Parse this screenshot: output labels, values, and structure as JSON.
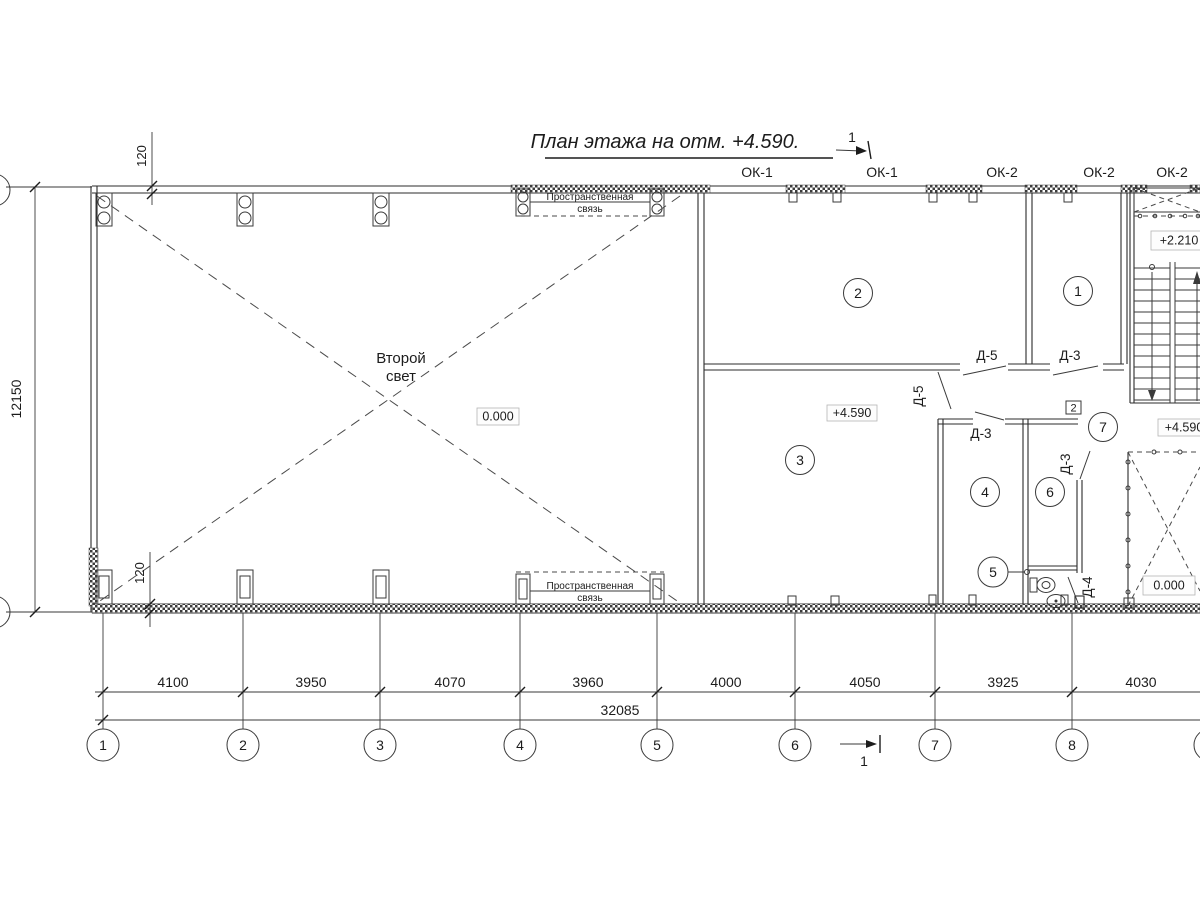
{
  "title": "План этажа на отм. +4.590.",
  "section_marker": {
    "top": "1",
    "bottom": "1"
  },
  "windows": {
    "labels": [
      "ОК-1",
      "ОК-1",
      "ОК-2",
      "ОК-2",
      "ОК-2"
    ]
  },
  "rooms": {
    "labels": [
      "1",
      "2",
      "3",
      "4",
      "5",
      "6",
      "7"
    ],
    "tag_room6": "2"
  },
  "elevations": {
    "second_light": "0.000",
    "room3": "+4.590",
    "stair_landing": "+2.210",
    "right_hall": "+4.590",
    "shaft": "0.000"
  },
  "doors": {
    "d5_top": "Д-5",
    "d3_top": "Д-3",
    "d5_side": "Д-5",
    "d3_room4": "Д-3",
    "d3_room6": "Д-3",
    "d4_wc": "Д-4"
  },
  "annotations": {
    "second_light_line1": "Второй",
    "second_light_line2": "свет",
    "spatial_line1": "Пространственная",
    "spatial_line2": "связь"
  },
  "dimensions": {
    "left_height": "12150",
    "wall_top": "120",
    "wall_bottom": "120",
    "spans": [
      "4100",
      "3950",
      "4070",
      "3960",
      "4000",
      "4050",
      "3925",
      "4030"
    ],
    "total": "32085"
  },
  "grid": {
    "axes": [
      "1",
      "2",
      "3",
      "4",
      "5",
      "6",
      "7",
      "8"
    ]
  }
}
